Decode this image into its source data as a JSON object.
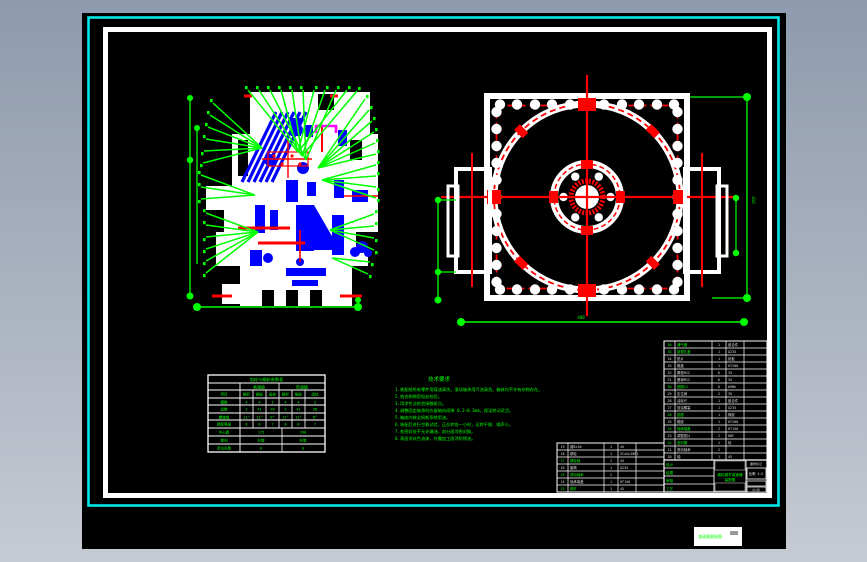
{
  "window": {
    "background_top": "#8e9aad",
    "background_bottom": "#c6cad3"
  },
  "palette": {
    "canvas_black": "#000000",
    "frame_cyan": "#00e8e8",
    "paper_white": "#ffffff",
    "line_green": "#00ff00",
    "line_red": "#ff0000",
    "fill_blue": "#0000ff",
    "accent_magenta": "#ff00ff"
  },
  "notes": {
    "title": "技术要求",
    "lines": [
      "1.装配前所有零件用煤油清洗，滚动轴承用汽油清洗，箱体内不许有杂物存在。",
      "2.啮合侧隙用铅丝检验。",
      "3.用涂色法检验接触斑点。",
      "4.调整固定轴承时应留轴向间隙 0.2~0.3mm，保证转动灵活。",
      "5.箱座内装全损耗系统用油。",
      "6.装配后进行空载试验，正反转各一小时，运转平稳、噪声小。",
      "7.各密封处不允许漏油，剖分面涂密封胶。",
      "8.表面涂灰色油漆，外露加工面涂防锈油。"
    ]
  },
  "param_table": {
    "title": "齿轮与蜗轮参数表",
    "sub_headers": [
      "",
      "高速级",
      "低速级"
    ],
    "col_headers": [
      "项目",
      "蜗杆",
      "蜗轮",
      "齿轮",
      "蜗杆",
      "蜗轮",
      "齿轮"
    ],
    "value_rows": [
      [
        "模数",
        "4",
        "4",
        "3",
        "4",
        "4",
        "3"
      ],
      [
        "齿数",
        "2",
        "41",
        "20",
        "2",
        "41",
        "58"
      ],
      [
        "螺旋角",
        "11°",
        "11°",
        "8°",
        "11°",
        "11°",
        "8°"
      ],
      [
        "精度等级",
        "8",
        "8",
        "7",
        "8",
        "8",
        "7"
      ]
    ],
    "merged_rows": [
      [
        "中心距",
        "125",
        "160"
      ],
      [
        "旋向",
        "右旋",
        "右旋"
      ],
      [
        "变位系数",
        "0",
        "0"
      ]
    ]
  },
  "bom_right": {
    "green_rows": [
      0,
      1,
      6,
      10,
      12,
      14
    ],
    "rows": [
      [
        "36",
        "通气器",
        "1",
        "组合件"
      ],
      [
        "35",
        "窥视孔盖",
        "1",
        "Q235"
      ],
      [
        "34",
        "垫片",
        "1",
        "纸板"
      ],
      [
        "33",
        "箱盖",
        "1",
        "HT200"
      ],
      [
        "32",
        "螺栓M12",
        "6",
        "35"
      ],
      [
        "31",
        "螺母M12",
        "6",
        "35"
      ],
      [
        "30",
        "垫圈12",
        "6",
        "65Mn"
      ],
      [
        "29",
        "定位销",
        "2",
        "35"
      ],
      [
        "28",
        "油标尺",
        "1",
        "组合件"
      ],
      [
        "27",
        "放油螺塞",
        "1",
        "Q235"
      ],
      [
        "26",
        "垫圈",
        "1",
        "橡胶"
      ],
      [
        "25",
        "箱座",
        "1",
        "HT200"
      ],
      [
        "24",
        "轴承端盖",
        "2",
        "HT150"
      ],
      [
        "23",
        "调整垫片",
        "2",
        "08F"
      ],
      [
        "22",
        "密封圈",
        "2",
        "毡"
      ],
      [
        "21",
        "滚动轴承",
        "2",
        ""
      ],
      [
        "20",
        "轴",
        "1",
        "45"
      ]
    ]
  },
  "bom_left": {
    "green_rows": [
      2,
      4,
      6
    ],
    "rows": [
      [
        "19",
        "键8×50",
        "1",
        "45",
        ""
      ],
      [
        "18",
        "蜗轮",
        "1",
        "ZCuSn10P1",
        ""
      ],
      [
        "17",
        "蜗轮轴",
        "1",
        "45",
        ""
      ],
      [
        "16",
        "套筒",
        "1",
        "Q235",
        ""
      ],
      [
        "15",
        "滚动轴承",
        "2",
        "",
        ""
      ],
      [
        "14",
        "轴承端盖",
        "1",
        "HT150",
        ""
      ],
      [
        "13",
        "蜗杆",
        "1",
        "45",
        ""
      ]
    ]
  },
  "title_block": {
    "left_rows": [
      "设计",
      "绘图",
      "审核",
      "工艺"
    ],
    "middle_green_line1": "蜗轮蜗杆减速器",
    "middle_green_line2": "装配图",
    "right_top": "图样标记",
    "scale_label": "比例 1:2",
    "sheet_label": "共1张"
  },
  "footer_label": {
    "text": "减速器装配图"
  },
  "dim_labels": {
    "right_view_bottom": "480",
    "right_view_side": "410"
  }
}
